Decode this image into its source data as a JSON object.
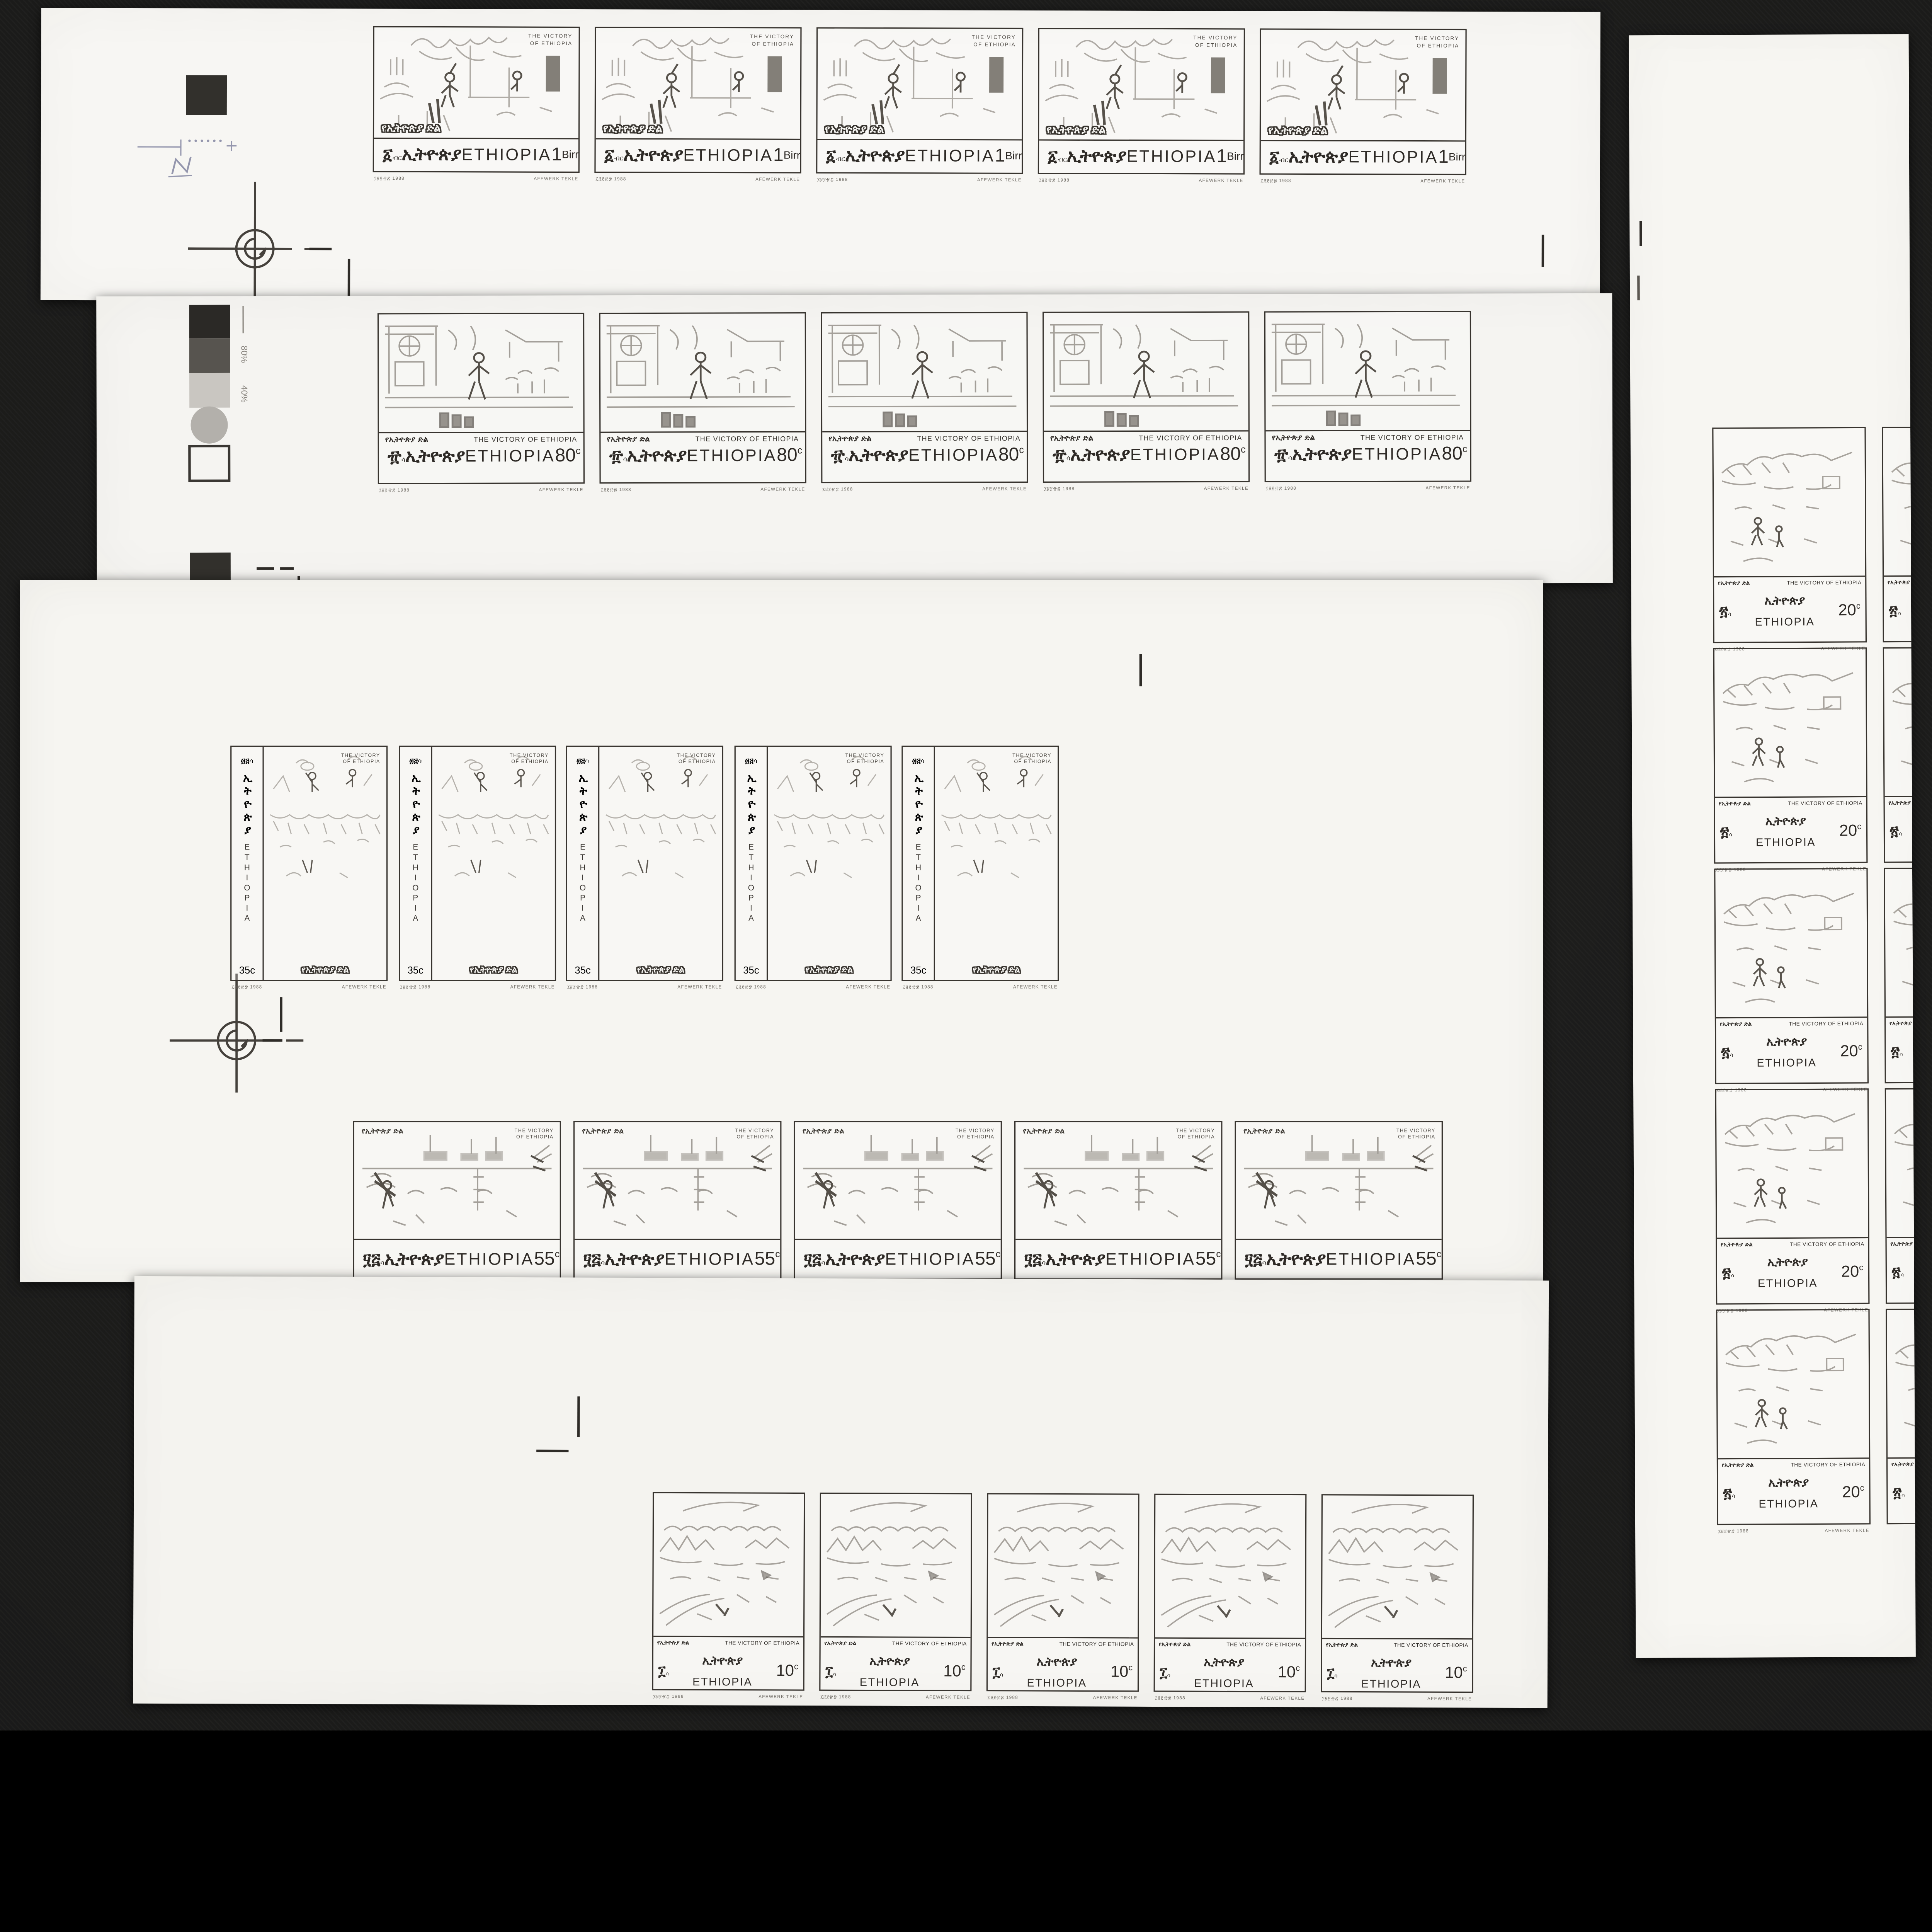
{
  "photo": {
    "background": "#1b1b1a",
    "paper": "#f6f5f2",
    "ink": "#38342f"
  },
  "common": {
    "title_en_line1": "THE VICTORY",
    "title_en_line2": "OF ETHIOPIA",
    "title_en_oneline": "THE VICTORY OF ETHIOPIA",
    "title_am": "የኢትዮጵያ ድል",
    "country_am": "ኢትዮጵያ",
    "country_en": "ETHIOPIA",
    "designer": "AFEWERK TEKLE",
    "issue_date": "፲፱፻፹፰ 1988"
  },
  "rows": {
    "birr1": {
      "count": 5,
      "am_numeral": "፩",
      "am_unit": "ብር",
      "value": "1",
      "unit": "Birr"
    },
    "c80": {
      "count": 5,
      "am_numeral": "፹",
      "am_unit": "ሳ",
      "value": "80",
      "unit": "c"
    },
    "c35": {
      "count": 5,
      "am_numeral": "፴፭",
      "am_unit": "ሳ",
      "value": "35",
      "unit": "c"
    },
    "c55": {
      "count": 5,
      "am_numeral": "፶፭",
      "am_unit": "ሳ",
      "value": "55",
      "unit": "c"
    },
    "c10": {
      "count": 5,
      "am_numeral": "፲",
      "am_unit": "ሳ",
      "value": "10",
      "unit": "c"
    },
    "c20": {
      "count": 5,
      "partial_column_count": 5,
      "am_numeral": "፳",
      "am_unit": "ሳ",
      "value": "20",
      "unit": "c"
    }
  },
  "calibration": {
    "label_80": "80%",
    "label_40": "40%",
    "pencil_note": "N"
  }
}
